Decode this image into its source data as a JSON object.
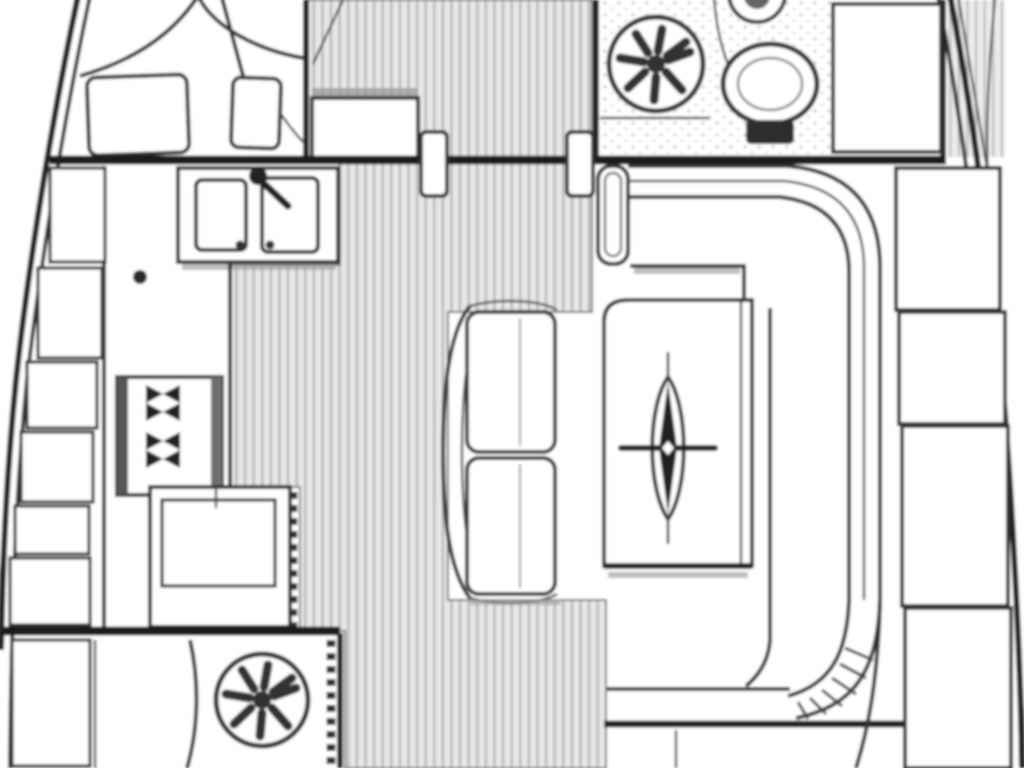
{
  "diagram": {
    "type": "sailing-yacht-interior-floor-plan",
    "orientation": "bow-up",
    "background_color": "#ffffff",
    "line_color": "#333333",
    "bulkhead_color": "#1c1c1c",
    "floor_base_color": "#ededed",
    "floor_stripe_color": "#b5b5b5",
    "shadow_color": "#9e9e9e"
  },
  "areas": [
    {
      "id": "forward-cabin",
      "features": [
        "v-berth-bed",
        "pillow",
        "pillow",
        "entry-step"
      ]
    },
    {
      "id": "head",
      "features": [
        "ventilation-fan-icon",
        "toilet-icon",
        "washbasin-icon",
        "counter"
      ]
    },
    {
      "id": "corridor",
      "features": [
        "plank-floor",
        "door-leaf",
        "door-leaf"
      ]
    },
    {
      "id": "galley",
      "features": [
        "double-sink",
        "faucet-icon",
        "stove-burner-icon",
        "stove-burner-icon",
        "counter",
        "hull-lockers"
      ]
    },
    {
      "id": "salon",
      "features": [
        "u-settee",
        "center-bench",
        "table",
        "compass-rose-icon",
        "hull-lockers"
      ]
    },
    {
      "id": "aft-compartment",
      "features": [
        "ventilation-fan-icon",
        "locker",
        "louver-edge"
      ]
    }
  ],
  "icons": [
    "ventilation-fan-icon",
    "toilet-icon",
    "washbasin-icon",
    "faucet-icon",
    "stove-burner-icon",
    "compass-rose-icon"
  ]
}
